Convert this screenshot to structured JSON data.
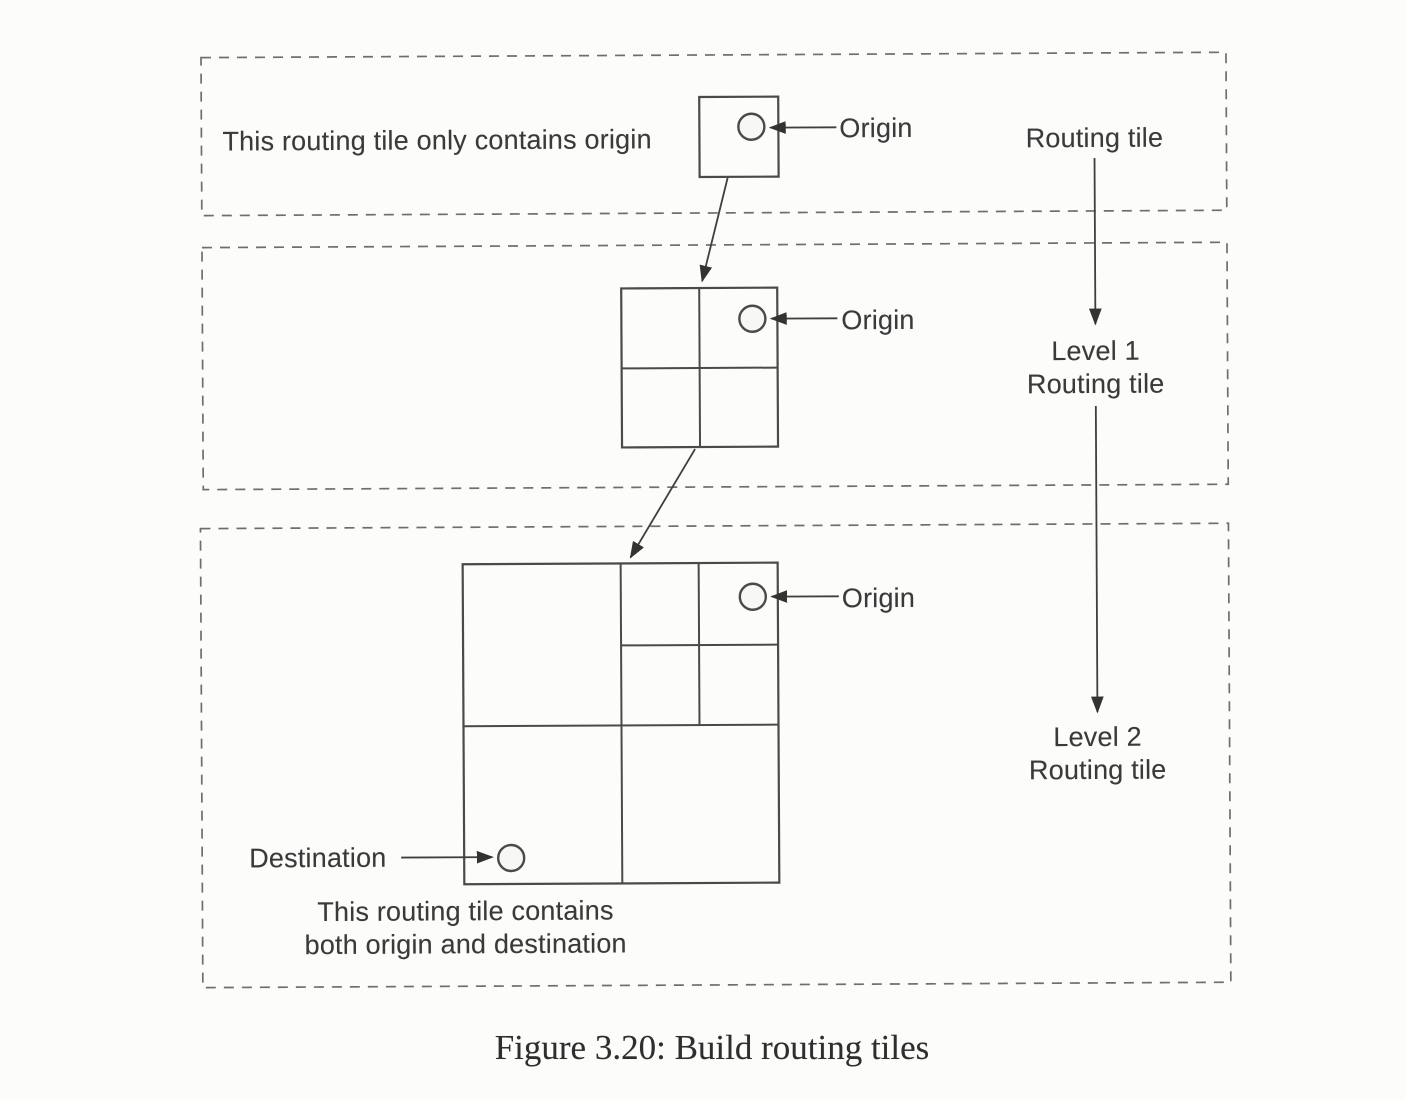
{
  "figure": {
    "caption": "Figure 3.20: Build routing tiles"
  },
  "labels": {
    "origin": "Origin",
    "destination": "Destination",
    "routing_tile": "Routing tile",
    "level1": "Level 1",
    "level2": "Level 2"
  },
  "panels": {
    "level0": {
      "note": "This routing tile only contains origin"
    },
    "level2": {
      "note_line1": "This routing tile contains",
      "note_line2": "both origin and destination"
    }
  },
  "colors": {
    "paper": "#fcfcfb",
    "ink": "#3a3a3a",
    "tile_line": "#4a4a4a",
    "dashed_border": "#6e6e6e",
    "caption_ink": "#2e2e2e"
  }
}
